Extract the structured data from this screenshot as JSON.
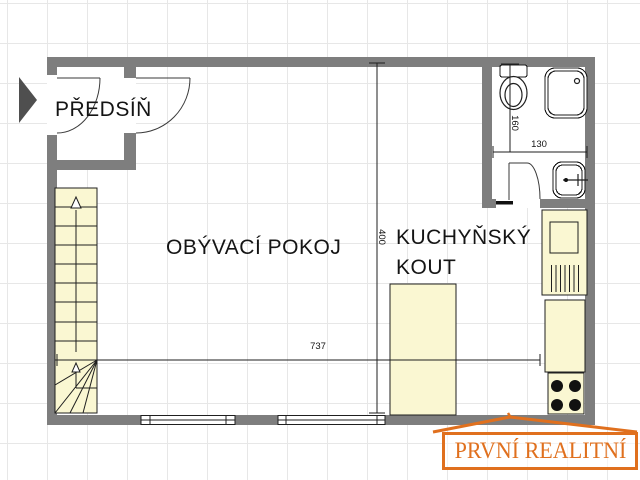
{
  "plan": {
    "rooms": {
      "hallway": {
        "label": "PŘEDSÍŇ"
      },
      "living_room": {
        "label": "OBÝVACÍ POKOJ"
      },
      "kitchenette": {
        "label_line1": "KUCHYŇSKÝ",
        "label_line2": "KOUT"
      }
    },
    "dimensions": {
      "living_width": "737",
      "living_height": "400",
      "bath_height": "160",
      "bath_width": "130"
    },
    "fixtures": [
      "entrance-arrow",
      "staircase",
      "toilet",
      "shower",
      "sink",
      "kitchen-counter",
      "stove",
      "kitchen-island",
      "windows",
      "doors"
    ]
  },
  "watermark": {
    "text": "PRVNÍ REALITNÍ"
  },
  "colors": {
    "wall": "#7E7E7E",
    "furniture": "#FAF7D2",
    "grid": "#E7E7E7",
    "line": "#1F1F1F",
    "arrow": "#4F4F4F",
    "logo": "#E0701E",
    "room": "#FFFFFF"
  }
}
